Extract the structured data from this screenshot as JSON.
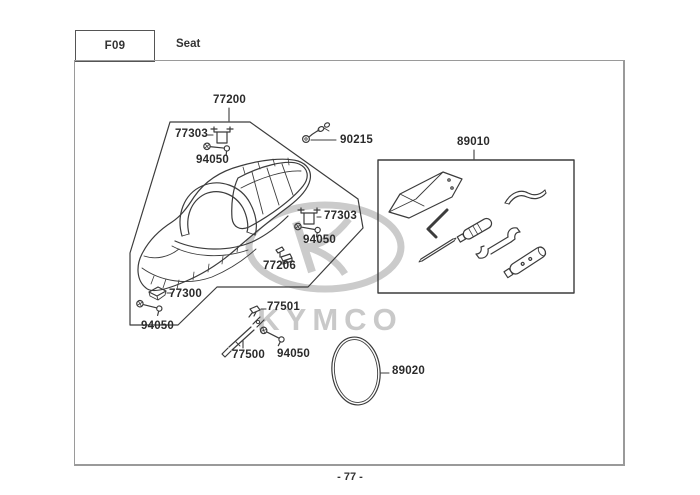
{
  "header": {
    "code": "F09",
    "title": "Seat"
  },
  "watermark": {
    "brand": "KYMCO"
  },
  "diagram": {
    "labels": [
      {
        "text": "77200"
      },
      {
        "text": "77303"
      },
      {
        "text": "94050"
      },
      {
        "text": "90215"
      },
      {
        "text": "89010"
      },
      {
        "text": "77303"
      },
      {
        "text": "94050"
      },
      {
        "text": "77206"
      },
      {
        "text": "77300"
      },
      {
        "text": "94050"
      },
      {
        "text": "77501"
      },
      {
        "text": "77500"
      },
      {
        "text": "94050"
      },
      {
        "text": "89020"
      }
    ]
  },
  "footer": {
    "page": "- 77 -"
  },
  "colors": {
    "line_art": "#3c3c3c",
    "label_text": "#2b2b2b",
    "watermark": "#cbcbcb",
    "border": "#9a9a9a"
  }
}
